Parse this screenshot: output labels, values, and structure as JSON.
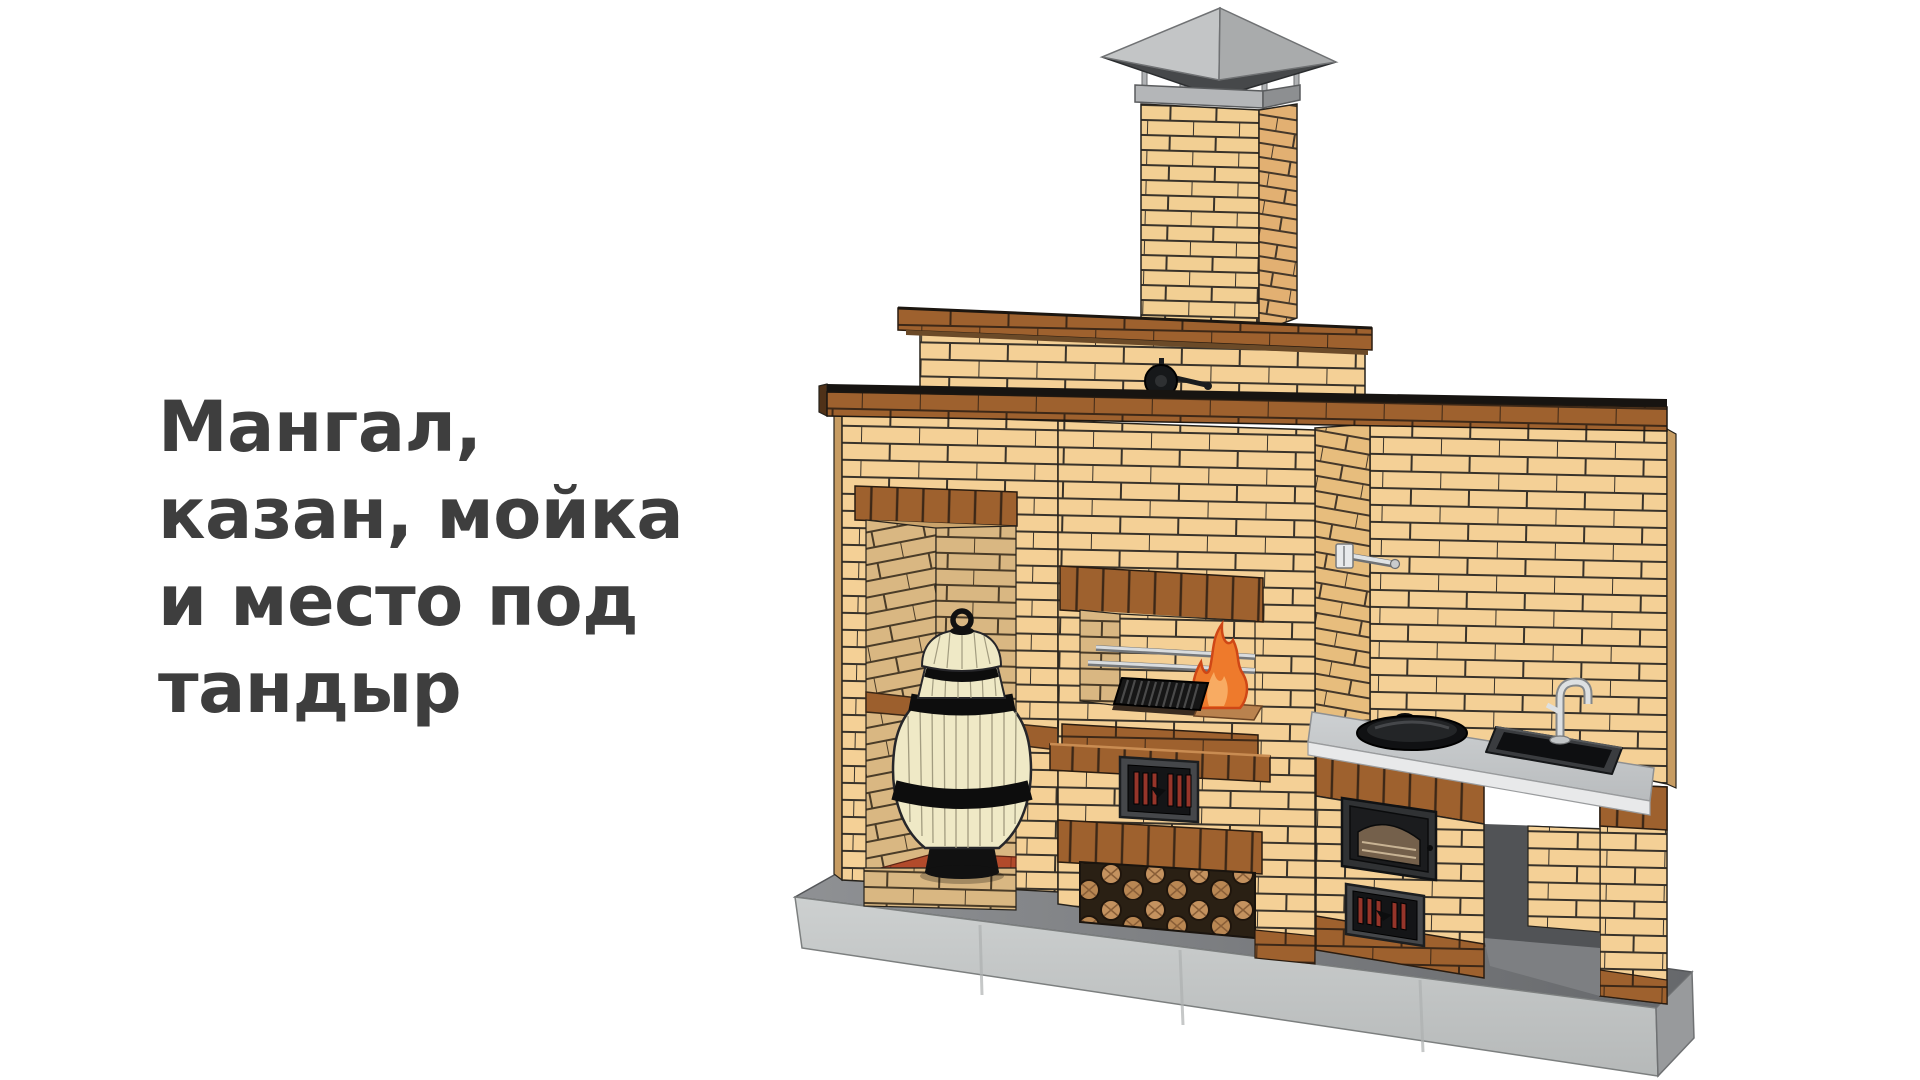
{
  "caption": {
    "lines": [
      "Мангал,",
      "казан, мойка",
      "и место под",
      "тандыр"
    ],
    "color": "#3e3e3e"
  },
  "scene": {
    "objects": {
      "chimney": "дымоход с металлическим колпаком",
      "chimney_cap": "колпак дымохода",
      "damper": "задвижка дымохода",
      "tandoor": "тандыр в нише",
      "tandoor_niche": "ниша под тандыр",
      "grill": "мангал с огнём",
      "skewers": "шампуры",
      "grate": "решётка мангала",
      "fire": "огонь",
      "ash_door": "поддувальная дверца",
      "woodshed": "дровник с дровами",
      "kazan": "казан",
      "oven_door": "топочная дверца со стеклом",
      "sink": "мойка",
      "faucet": "смеситель",
      "wall_tap": "кран на стене",
      "countertop": "столешница",
      "base_slab": "бетонное основание"
    },
    "colors": {
      "brick_light": "#f4d096",
      "brick_brown": "#9e612e",
      "brick_interior": "#d9b782",
      "brick_side": "#e7bd7d",
      "concrete_slab": "#c7c9c9",
      "metal_cap": "#b5b7b9",
      "fire_orange": "#ee7a2c",
      "tandoor_body": "#efe9c6",
      "floor_tile": "#b24a2b",
      "caption_text": "#3e3e3e",
      "background": "#ffffff"
    }
  }
}
